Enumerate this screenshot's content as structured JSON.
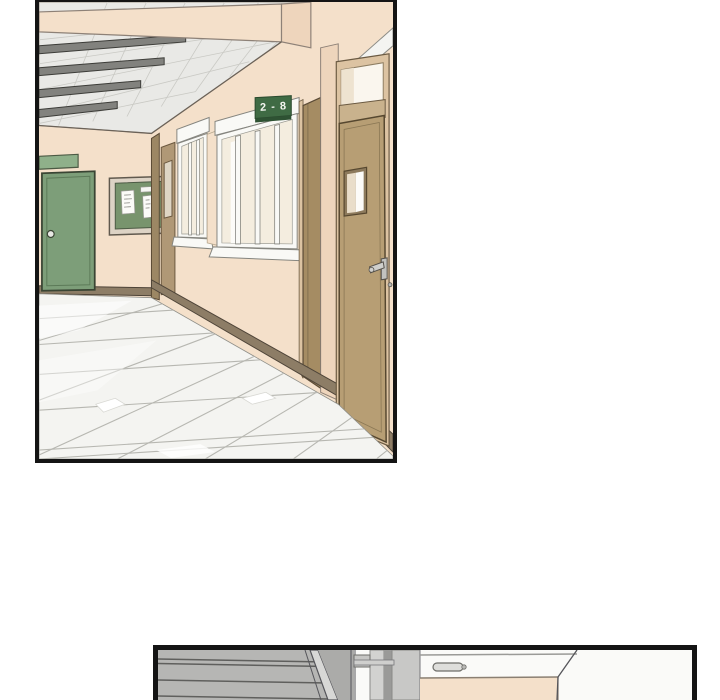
{
  "page": {
    "width": 720,
    "height": 700,
    "background": "#ffffff"
  },
  "panel1": {
    "name": "hallway-panel",
    "room_sign": {
      "text": "2 - 8",
      "bg": "#3f6b44",
      "text_color": "#f2f5ef"
    },
    "objects": [
      "ceiling-tiles",
      "fluorescent-lights",
      "overhead-beam",
      "green-door",
      "green-door-plate",
      "bulletin-board",
      "bulletin-papers",
      "far-corner-door",
      "hallway-window-far",
      "hallway-window-near",
      "room-number-sign",
      "edge-on-classroom-door",
      "corner-pillar",
      "near-door-transom",
      "near-classroom-door",
      "door-handle",
      "baseboard",
      "tiled-floor"
    ]
  },
  "panel2": {
    "name": "classroom-top-partial-panel",
    "objects": [
      "window-blinds-slats",
      "diagonal-frame-pole",
      "door-top",
      "door-pull-handle",
      "beige-wall-board",
      "corner-wall"
    ]
  },
  "colors": {
    "panel_border": "#141414",
    "wall": "#f4e0ca",
    "wall_dark": "#eed5bc",
    "ceiling": "#e9e9e6",
    "light_fixture": "#82827e",
    "green_door": "#7d9e79",
    "green_plate": "#8fb08a",
    "board_green": "#78946d",
    "board_frame": "#ddd3c5",
    "sign_bg": "#3f6b44",
    "sign_edge": "#2e5233",
    "sign_text": "#f2f5ef",
    "door_tan": "#b79e74",
    "door_tan_dark": "#a58c63",
    "door_frame_tan": "#dcc3a2",
    "window_frame": "#f9f9f6",
    "glass": "#f4eddf",
    "baseboard": "#8d7d66",
    "floor": "#f4f4f1",
    "grout": "#b7b7b1",
    "slat_gray": "#b6b6b4",
    "slat_line": "#5f5f5d"
  }
}
